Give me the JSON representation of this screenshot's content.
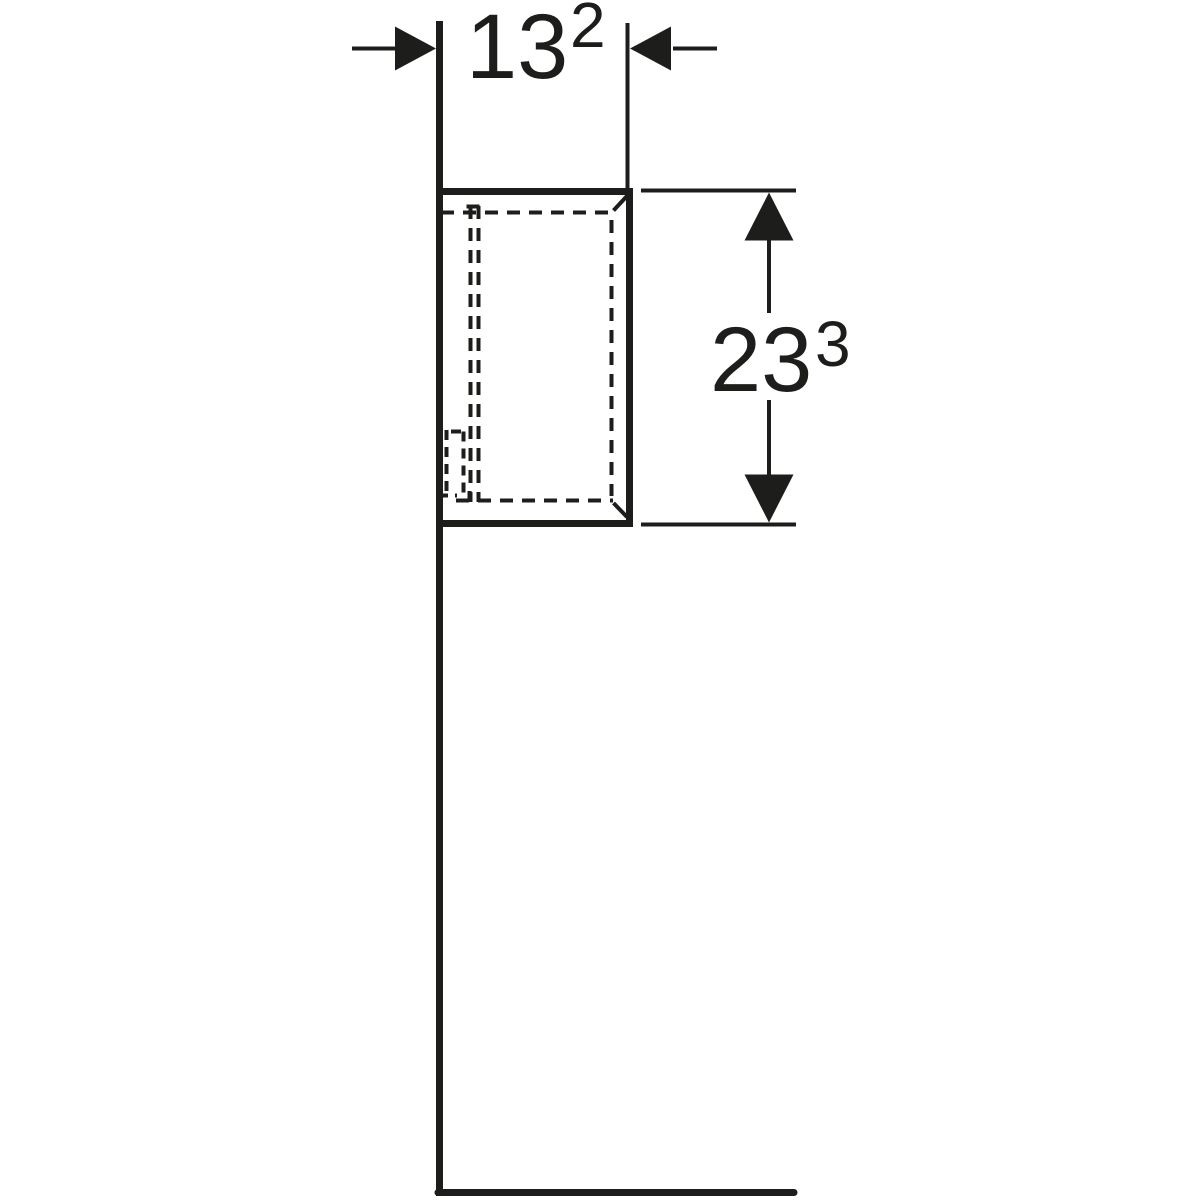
{
  "page": {
    "background": "#ffffff",
    "line_color": "#1d1d1b"
  },
  "drawing": {
    "type": "technical-dimension-drawing",
    "subject": "wall-hung cabinet side elevation with wall and floor lines",
    "width_dimension": {
      "value": "13",
      "superscript": "2"
    },
    "height_dimension": {
      "value": "23",
      "superscript": "3"
    }
  }
}
